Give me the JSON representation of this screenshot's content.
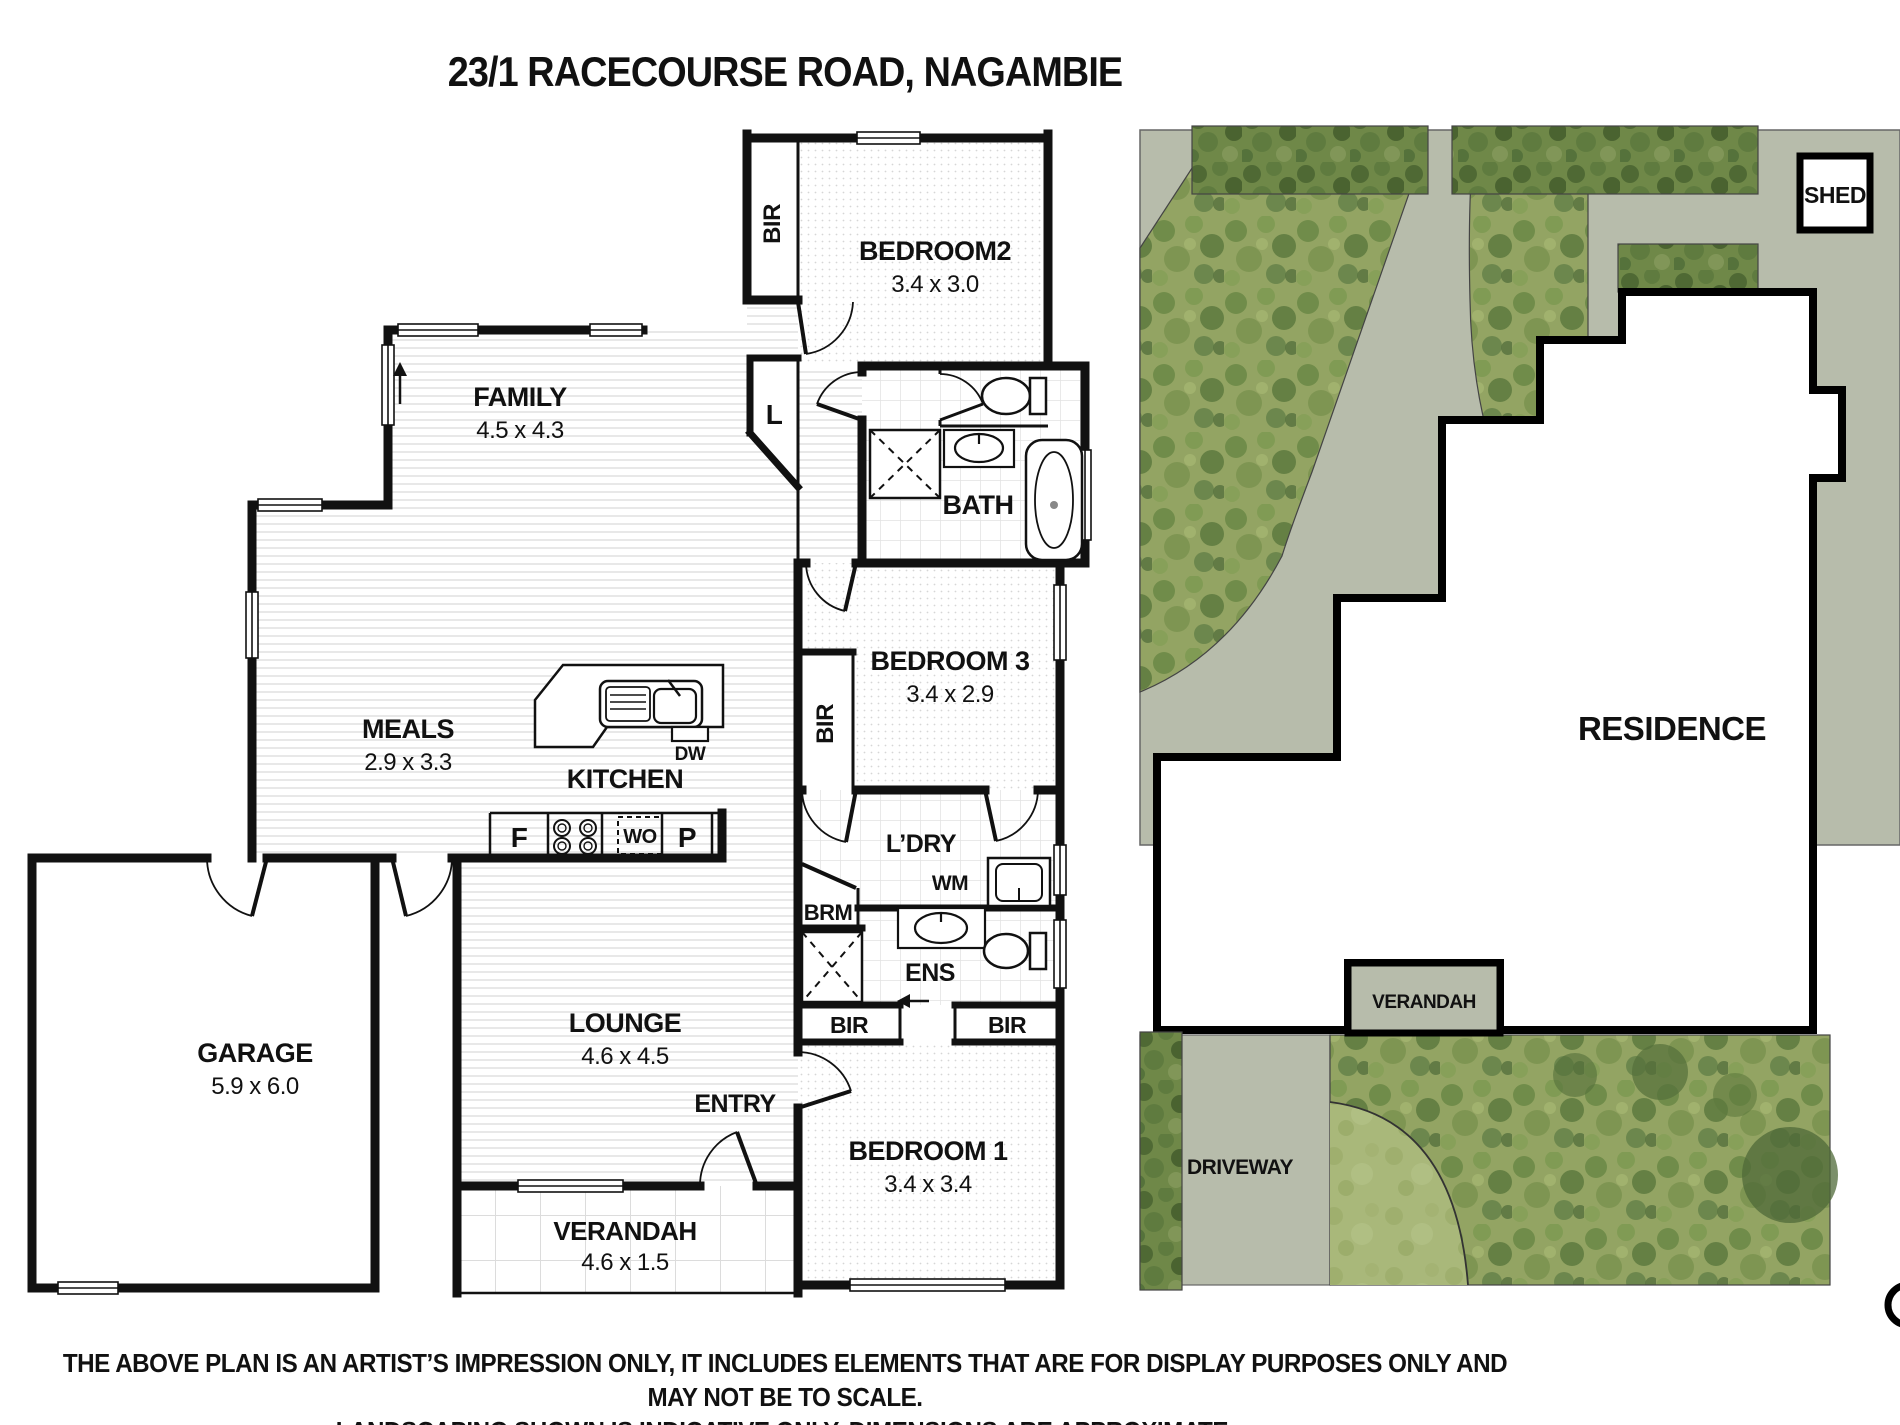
{
  "title": "23/1 RACECOURSE ROAD, NAGAMBIE",
  "floorplan": {
    "rooms": {
      "bedroom2": {
        "name": "BEDROOM2",
        "dims": "3.4 x 3.0"
      },
      "family": {
        "name": "FAMILY",
        "dims": "4.5 x 4.3"
      },
      "bath": {
        "name": "BATH"
      },
      "bedroom3": {
        "name": "BEDROOM 3",
        "dims": "3.4 x 2.9"
      },
      "meals": {
        "name": "MEALS",
        "dims": "2.9 x 3.3"
      },
      "kitchen": {
        "name": "KITCHEN"
      },
      "laundry": {
        "name": "L’DRY"
      },
      "ensuite": {
        "name": "ENS"
      },
      "garage": {
        "name": "GARAGE",
        "dims": "5.9 x 6.0"
      },
      "lounge": {
        "name": "LOUNGE",
        "dims": "4.6 x 4.5"
      },
      "entry": {
        "name": "ENTRY"
      },
      "bedroom1": {
        "name": "BEDROOM 1",
        "dims": "3.4 x 3.4"
      },
      "verandah": {
        "name": "VERANDAH",
        "dims": "4.6 x 1.5"
      }
    },
    "fixtures": {
      "bir": "BIR",
      "linen": "L",
      "broom": "BRM",
      "washing_machine": "WM",
      "dishwasher": "DW",
      "fridge": "F",
      "wall_oven": "WO",
      "pantry": "P"
    }
  },
  "siteplan": {
    "labels": {
      "shed": "SHED",
      "residence": "RESIDENCE",
      "verandah": "VERANDAH",
      "driveway": "DRIVEWAY"
    },
    "colors": {
      "hardscape": "#b7bcab",
      "garden": "#8fa15f",
      "grass": "#a9b87a"
    }
  },
  "disclaimer": {
    "line1": "THE ABOVE PLAN IS AN ARTIST’S IMPRESSION ONLY, IT INCLUDES ELEMENTS THAT ARE FOR DISPLAY PURPOSES ONLY AND MAY NOT BE TO SCALE.",
    "line2": "LANDSCAPING SHOWN IS INDICATIVE ONLY. DIMENSIONS ARE APPROXIMATE."
  }
}
